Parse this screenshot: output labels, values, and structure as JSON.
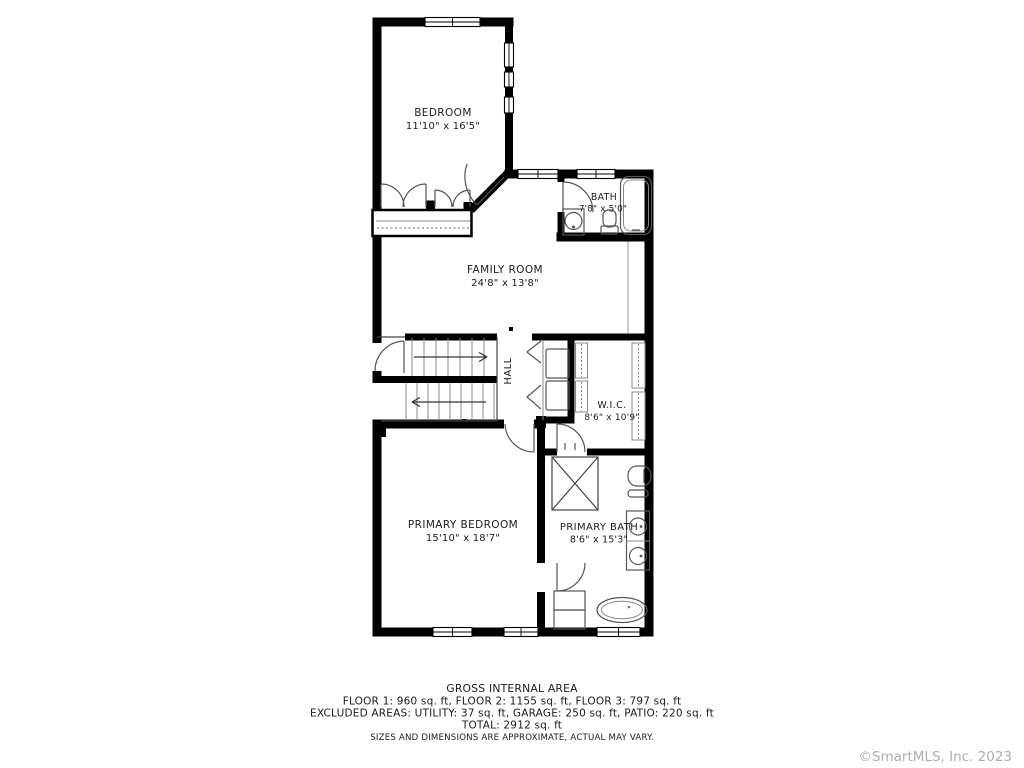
{
  "plan": {
    "rooms": [
      {
        "id": "bedroom",
        "name": "BEDROOM",
        "dims": "11'10\" x 16'5\""
      },
      {
        "id": "bath",
        "name": "BATH",
        "dims": "7'8\" x 5'0\""
      },
      {
        "id": "family-room",
        "name": "FAMILY ROOM",
        "dims": "24'8\" x 13'8\""
      },
      {
        "id": "hall",
        "name": "HALL",
        "dims": ""
      },
      {
        "id": "wic",
        "name": "W.I.C.",
        "dims": "8'6\" x 10'9\""
      },
      {
        "id": "primary-bedroom",
        "name": "PRIMARY BEDROOM",
        "dims": "15'10\" x 18'7\""
      },
      {
        "id": "primary-bath",
        "name": "PRIMARY BATH",
        "dims": "8'6\" x 15'3\""
      }
    ],
    "colors": {
      "wall": "#000000",
      "fixture": "#555555",
      "label": "#1c1c1c"
    }
  },
  "footer": {
    "title": "GROSS INTERNAL AREA",
    "line1": "FLOOR 1: 960 sq. ft, FLOOR 2: 1155 sq. ft, FLOOR 3: 797 sq. ft",
    "line2": "EXCLUDED AREAS: UTILITY: 37 sq. ft, GARAGE: 250 sq. ft, PATIO: 220 sq. ft",
    "line3": "TOTAL: 2912 sq. ft",
    "disclaimer": "SIZES AND DIMENSIONS ARE APPROXIMATE, ACTUAL MAY VARY."
  },
  "watermark": {
    "text": "©SmartMLS, Inc. 2023",
    "color": "#aeaeae"
  }
}
